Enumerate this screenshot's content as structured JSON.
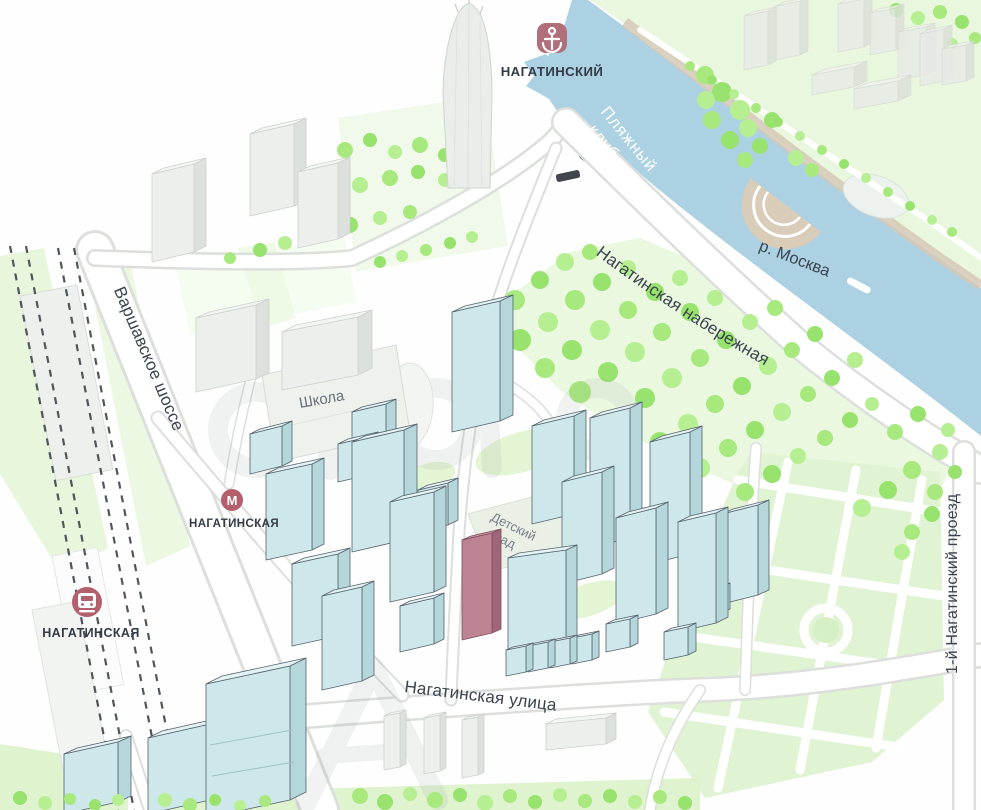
{
  "map": {
    "project_marker": {
      "label": "НАГАТИНСКИЙ",
      "icon": "anchor"
    },
    "stations": {
      "metro": {
        "label": "НАГАТИНСКАЯ",
        "icon": "М"
      },
      "railway": {
        "label": "НАГАТИНСКАЯ",
        "icon": "train"
      }
    },
    "streets": {
      "varshavskoe_shosse": "Варшавское шоссе",
      "nagatinskaya_naberezhnaya": "Нагатинская набережная",
      "nagatinskaya_ulitsa": "Нагатинская улица",
      "nagatinsky_proezd": "1-й Нагатинский проезд"
    },
    "labels": {
      "river": "р. Москва",
      "beach_club_lines": [
        "Пляжный",
        "клуб"
      ],
      "school": "Школа",
      "kindergarten_lines": [
        "Детский",
        "сад"
      ]
    },
    "colors": {
      "water": "#abd1e3",
      "tree": "#a8e97e",
      "lawn": "#e6f6d8",
      "building_blue": "#cde7ea",
      "building_highlight": "#bc8392",
      "marker_rose": "#b45f6d",
      "label_dark": "#3a434e"
    }
  }
}
